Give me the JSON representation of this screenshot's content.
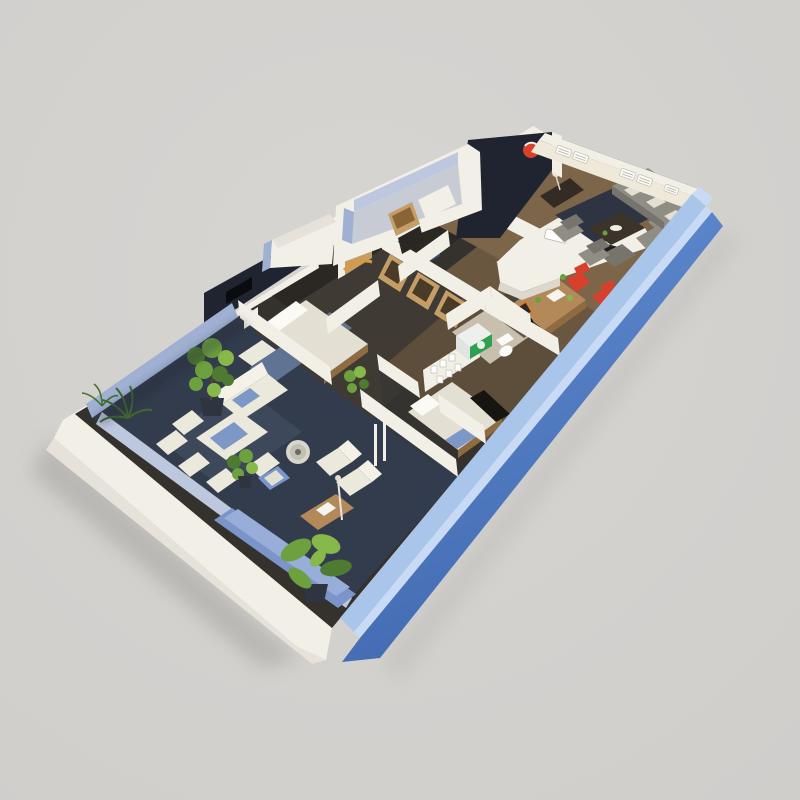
{
  "scene": {
    "kind": "3D isometric cutaway floor-plan render",
    "subject": "long rectangular apartment model with open roof, floating on a plain studio backdrop",
    "orientation": "building runs diagonally from the lower-left tip to the upper-right end",
    "background": "plain warm light-gray with a soft drop shadow under the model"
  },
  "colors": {
    "bg": "#d7d5d2",
    "bg-edge": "#d0cecb",
    "white-top": "#f2efe7",
    "white-face": "#e6e2d9",
    "white-warm": "#efe9da",
    "white-dim": "#dcd8cd",
    "lav-wall": "#9fb0d2",
    "lav-wall2": "#bdc8de",
    "navy-wall": "#202430",
    "charcoal-wall": "#262220",
    "blue-top": "#c9dbf4",
    "blue-inner": "#a9c5e9",
    "blue-outer": "#6690d4",
    "blue-outer-deep": "#416ab1",
    "terrace-floor": "#333c4c",
    "terrace-rug": "#404a5e",
    "corridor-floor": "#2b2824",
    "bedroom-floor": "#3f3a34",
    "office-floor": "#6a573f",
    "living-floor": "#7d6549",
    "living-rug": "#2e3442",
    "bath-floor": "#c9bfae",
    "wood": "#b4895a",
    "wood-dark": "#8f6b42",
    "tan-closet": "#c59d66",
    "sofa-gray": "#8f8d84",
    "sofa-gray-dark": "#76746c",
    "cushion": "#e3dfd2",
    "outdoor-white": "#ebe8dc",
    "outdoor-blue": "#7d97c6",
    "blue-sofa": "#7b95ca",
    "blue-sofa-light": "#98aed8",
    "green1": "#4e7a32",
    "green2": "#6da03f",
    "green3": "#86b84a",
    "pot-dark": "#2e3440",
    "red-accent": "#d8402c",
    "orange-accent": "#e07a1f",
    "green-washer": "#2fa052",
    "black-tv": "#0a0c10"
  },
  "exterior": {
    "outer_walls": "white plinth and end walls",
    "accent_wall": "long light-blue exterior wall along the lower-right side",
    "vents": "three pairs of louvered white window vents on the upper-right end wall"
  },
  "rooms": [
    {
      "name": "living-room",
      "floor": "warm wood",
      "items": [
        "gray L-shaped sectional sofa with white pillows",
        "dark coffee table on navy rug",
        "two gray armchairs",
        "dark media console with table lamp",
        "tall dark-navy accent wall with round red artwork"
      ]
    },
    {
      "name": "kitchen",
      "floor": "wood",
      "items": [
        "white L-shaped counter",
        "inset sink",
        "black cooktop",
        "red chair nook with plant"
      ]
    },
    {
      "name": "home-office",
      "floor": "wood",
      "items": [
        "wooden desk with laptop and plants",
        "black and orange office chair",
        "wooden shelf unit",
        "red side chair by blue wall"
      ]
    },
    {
      "name": "master-bedroom",
      "floor": "dark brown",
      "items": [
        "white double bed on wood base",
        "dark navy accent wall with TV",
        "red arc artwork",
        "wood-front wardrobe",
        "blue rug",
        "white bench",
        "amber arc lamp"
      ]
    },
    {
      "name": "walk-in-closet",
      "items": [
        "zigzag row of open wooden wardrobe units"
      ]
    },
    {
      "name": "second-bedroom",
      "floor": "dark",
      "items": [
        "white bed with blue throw",
        "gallery wall with six small frames",
        "dark side panel",
        "white door posts",
        "potted plant"
      ]
    },
    {
      "name": "bathroom-laundry",
      "floor": "beige tile",
      "items": [
        "washing machine with green door",
        "white toilet"
      ]
    },
    {
      "name": "hallway",
      "floor": "dark wood",
      "items": [
        "dark charcoal wall with doorways",
        "small blue artwork"
      ]
    },
    {
      "name": "annex-room",
      "items": [
        "white room protruding on upper-left side",
        "wooden cabinet",
        "single white bed",
        "small white entry box"
      ]
    },
    {
      "name": "terrace-lounge",
      "floor": "dark slate",
      "items": [
        "white outdoor dining table with blue runner and chairs",
        "white three-seat sofa",
        "round fire-pit table",
        "two white loungers",
        "blue armchair",
        "wooden coffee table",
        "long blue wall sofa",
        "floor lamp",
        "fiddle-leaf plant",
        "palm plants",
        "large banana plant"
      ]
    }
  ]
}
